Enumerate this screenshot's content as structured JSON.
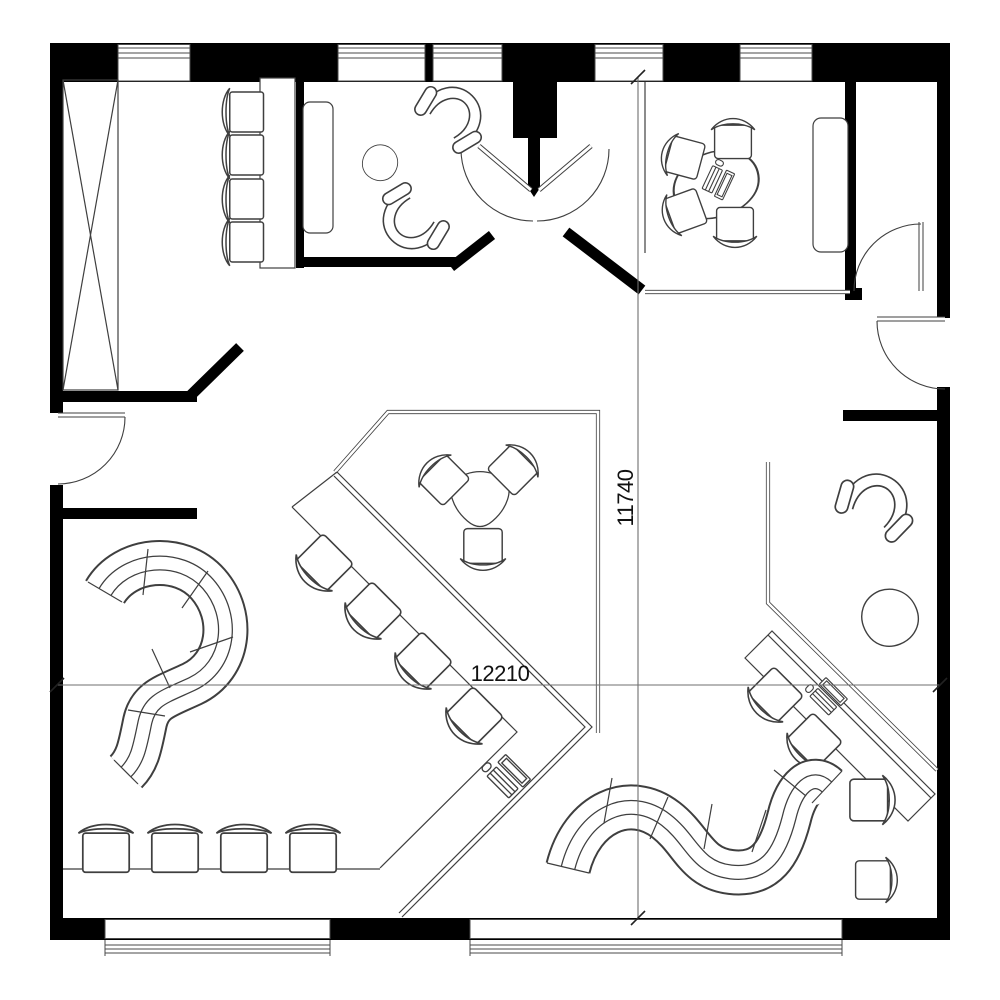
{
  "dimensions": {
    "horizontal_label": "12210",
    "vertical_label": "11740"
  },
  "colors": {
    "background": "#ffffff",
    "wall": "#000000",
    "line": "#3f3f3f",
    "dim_line": "#6f6f6f",
    "text": "#111111"
  }
}
